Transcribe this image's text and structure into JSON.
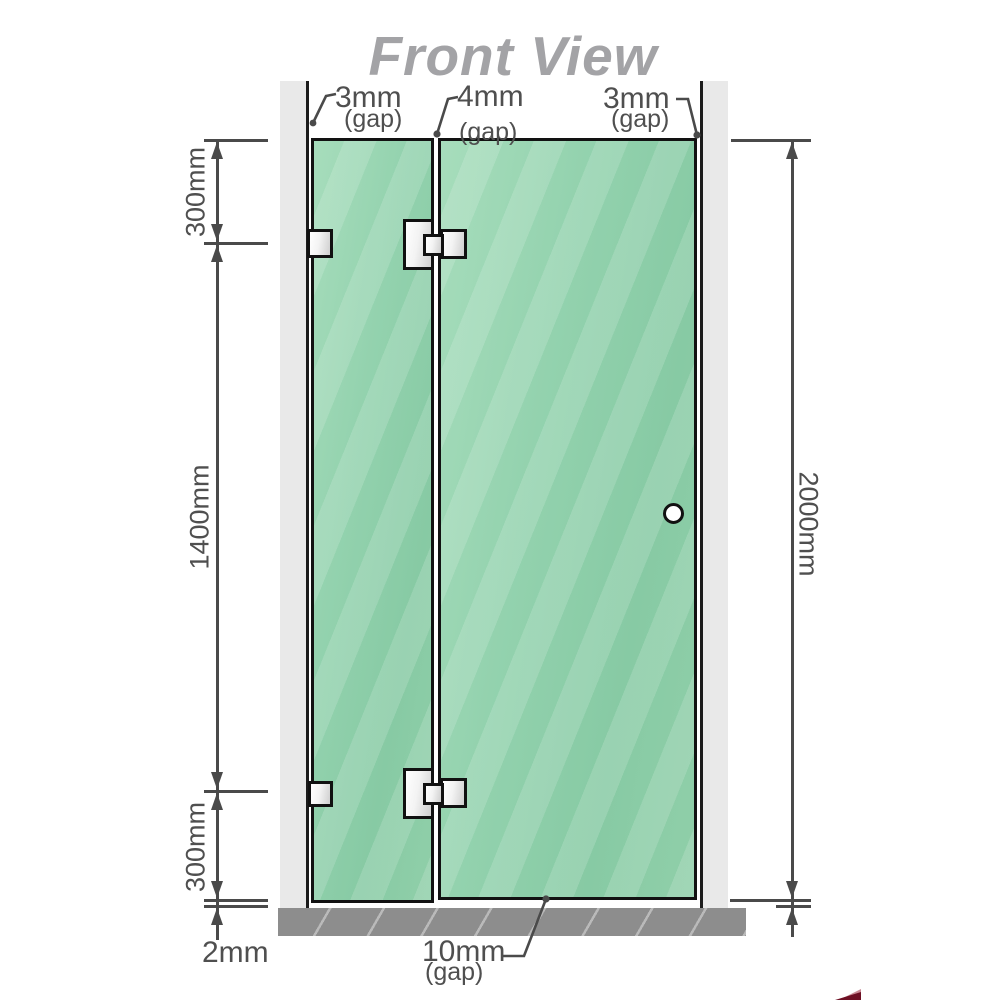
{
  "title": "Front View",
  "top_gaps": [
    {
      "value": "3mm",
      "suffix": "(gap)"
    },
    {
      "value": "4mm",
      "suffix": "(gap)"
    },
    {
      "value": "3mm",
      "suffix": "(gap)"
    }
  ],
  "left_dimensions": {
    "top": "300mm",
    "middle": "1400mm",
    "bottom": "300mm"
  },
  "right_dimension": "2000mm",
  "bottom_labels": {
    "floor_offset": "2mm",
    "door_gap": {
      "value": "10mm",
      "suffix": "(gap)"
    }
  },
  "colors": {
    "glass_green": "#8ecfa9",
    "glass_highlight": "#a7ddbc",
    "wall_gray": "#e9e9e9",
    "floor_gray": "#8d8d8d",
    "line_gray": "#4a4a4a",
    "text_gray": "#4f4f4f",
    "title_gray": "#a3a3a6",
    "hinge_metal": "#e8e8e8",
    "corner_accent_red": "#6e1024"
  }
}
